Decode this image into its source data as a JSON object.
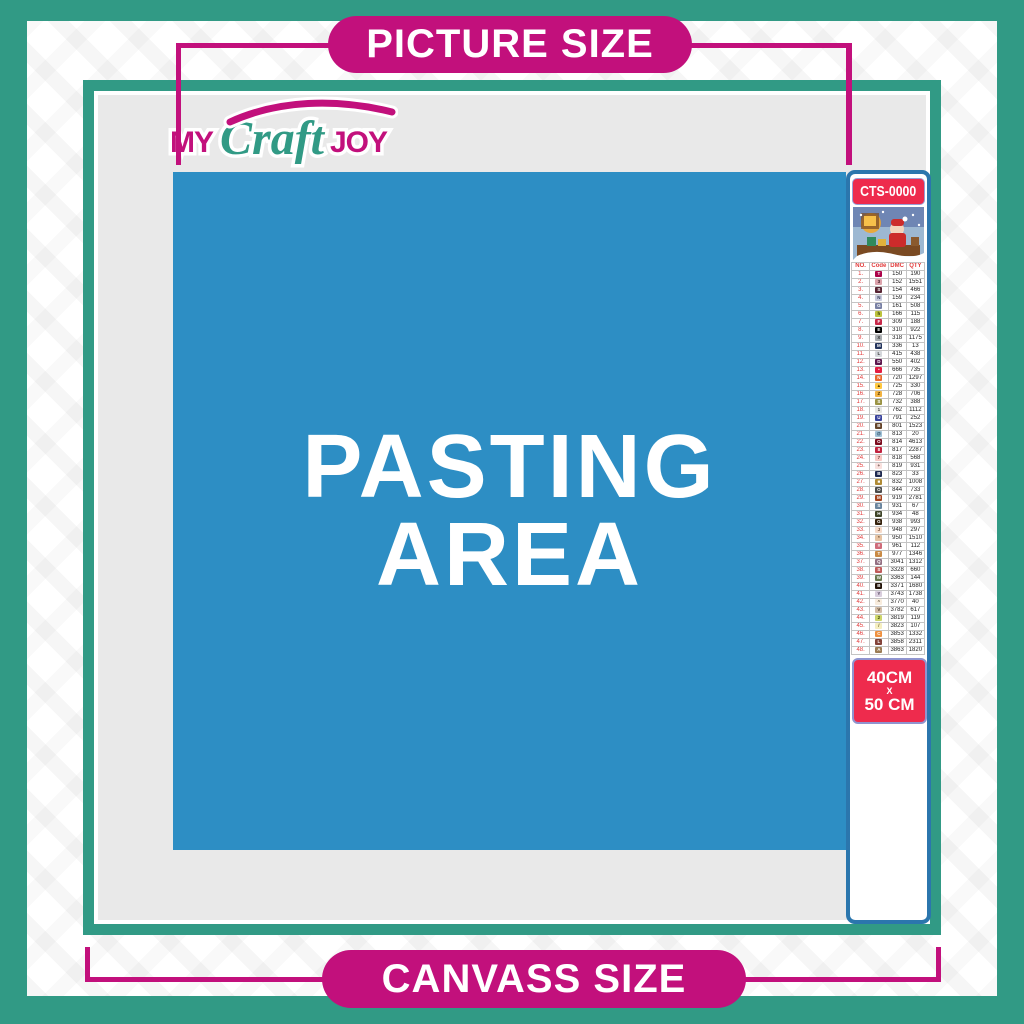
{
  "banners": {
    "top": "PICTURE SIZE",
    "bottom": "CANVASS SIZE"
  },
  "logo": {
    "my": "MY",
    "craft": "Craft",
    "joy": "JOY"
  },
  "pasting_area": {
    "line1": "PASTING",
    "line2": "AREA"
  },
  "product_strip": {
    "code_label": "CTS-0000",
    "thumbnail": "santa-claus-sleigh-christmas-scene",
    "size_label": {
      "width": "40CM",
      "separator": "X",
      "height": "50 CM"
    }
  },
  "color_table": {
    "headers": [
      "NO.",
      "Code",
      "DMC",
      "QTY"
    ],
    "rows": [
      [
        1,
        "T",
        "#ab0249",
        "#ffffff",
        "150",
        "190"
      ],
      [
        2,
        "3",
        "#dca3ac",
        "#3a1a22",
        "152",
        "1551"
      ],
      [
        3,
        "S",
        "#572433",
        "#ffffff",
        "154",
        "466"
      ],
      [
        4,
        "N",
        "#c9cbdd",
        "#333a55",
        "159",
        "234"
      ],
      [
        5,
        "G",
        "#7880a4",
        "#ffffff",
        "161",
        "508"
      ],
      [
        6,
        "h",
        "#bcc33d",
        "#333a10",
        "166",
        "115"
      ],
      [
        7,
        "F",
        "#c72849",
        "#ffffff",
        "309",
        "188"
      ],
      [
        8,
        "E",
        "#000000",
        "#ffffff",
        "310",
        "922"
      ],
      [
        9,
        "X",
        "#a9adb0",
        "#2b2b2b",
        "318",
        "1175"
      ],
      [
        10,
        "M",
        "#25365e",
        "#ffffff",
        "336",
        "13"
      ],
      [
        11,
        "L",
        "#d5d8dc",
        "#333333",
        "415",
        "438"
      ],
      [
        12,
        "D",
        "#5c184e",
        "#ffffff",
        "550",
        "402"
      ],
      [
        13,
        "•",
        "#e31d42",
        "#ffffff",
        "666",
        "735"
      ],
      [
        14,
        "N",
        "#e9692c",
        "#ffffff",
        "720",
        "1297"
      ],
      [
        15,
        "▲",
        "#ffc840",
        "#553c00",
        "725",
        "330"
      ],
      [
        16,
        "Z",
        "#f3b443",
        "#4d3500",
        "728",
        "706"
      ],
      [
        17,
        "S",
        "#9a9344",
        "#ffffff",
        "732",
        "388"
      ],
      [
        18,
        "1",
        "#e7e7e4",
        "#444444",
        "762",
        "1112"
      ],
      [
        19,
        "U",
        "#39439c",
        "#ffffff",
        "791",
        "252"
      ],
      [
        20,
        "B",
        "#65452b",
        "#ffffff",
        "801",
        "1523"
      ],
      [
        21,
        "@",
        "#a1c2d7",
        "#23445a",
        "813",
        "20"
      ],
      [
        22,
        "O",
        "#7b0c1e",
        "#ffffff",
        "814",
        "4613"
      ],
      [
        23,
        "8",
        "#c1233f",
        "#ffffff",
        "817",
        "2287"
      ],
      [
        24,
        "7",
        "#f8c9c4",
        "#6b3a36",
        "818",
        "568"
      ],
      [
        25,
        "+",
        "#f8e0dd",
        "#6b4a46",
        "819",
        "931"
      ],
      [
        26,
        "B",
        "#1f2a50",
        "#ffffff",
        "823",
        "33"
      ],
      [
        27,
        "■",
        "#b08b36",
        "#ffffff",
        "832",
        "1008"
      ],
      [
        28,
        "O",
        "#4c4c4c",
        "#ffffff",
        "844",
        "733"
      ],
      [
        29,
        "M",
        "#a4441f",
        "#ffffff",
        "919",
        "2781"
      ],
      [
        30,
        "S",
        "#6a859e",
        "#ffffff",
        "931",
        "67"
      ],
      [
        31,
        "H",
        "#3f4529",
        "#ffffff",
        "934",
        "48"
      ],
      [
        32,
        "G",
        "#36220c",
        "#ffffff",
        "938",
        "993"
      ],
      [
        33,
        "J",
        "#f7dbc9",
        "#6e4630",
        "948",
        "297"
      ],
      [
        34,
        "*",
        "#e6c3a2",
        "#5c3e24",
        "950",
        "1510"
      ],
      [
        35,
        "#",
        "#cf6b79",
        "#ffffff",
        "961",
        "112"
      ],
      [
        36,
        "T",
        "#c98a45",
        "#ffffff",
        "977",
        "1346"
      ],
      [
        37,
        "Q",
        "#937083",
        "#ffffff",
        "3041",
        "1312"
      ],
      [
        38,
        "S",
        "#c05b5b",
        "#ffffff",
        "3328",
        "660"
      ],
      [
        39,
        "W",
        "#68794f",
        "#ffffff",
        "3363",
        "144"
      ],
      [
        40,
        "B",
        "#24150a",
        "#ffffff",
        "3371",
        "1680"
      ],
      [
        41,
        "Y",
        "#d9cedd",
        "#4a3e55",
        "3743",
        "1738"
      ],
      [
        42,
        "^",
        "#f8ecdd",
        "#6b5a40",
        "3770",
        "40"
      ],
      [
        43,
        "V",
        "#d2bca6",
        "#4f3d29",
        "3782",
        "617"
      ],
      [
        44,
        "2",
        "#cdd56b",
        "#3c420f",
        "3819",
        "119"
      ],
      [
        45,
        "/",
        "#f5eec0",
        "#6a611f",
        "3823",
        "107"
      ],
      [
        46,
        "C",
        "#ef9140",
        "#ffffff",
        "3853",
        "1332"
      ],
      [
        47,
        "L",
        "#83433a",
        "#ffffff",
        "3858",
        "2311"
      ],
      [
        48,
        "A",
        "#9b7c55",
        "#ffffff",
        "3863",
        "1820"
      ]
    ]
  },
  "colors": {
    "teal": "#319a85",
    "magenta": "#c2107c",
    "pasting_blue": "#2d8ec4",
    "panel_grey": "#e9e9e9",
    "label_red": "#ee2b4d",
    "strip_border_blue": "#2b76ad"
  }
}
